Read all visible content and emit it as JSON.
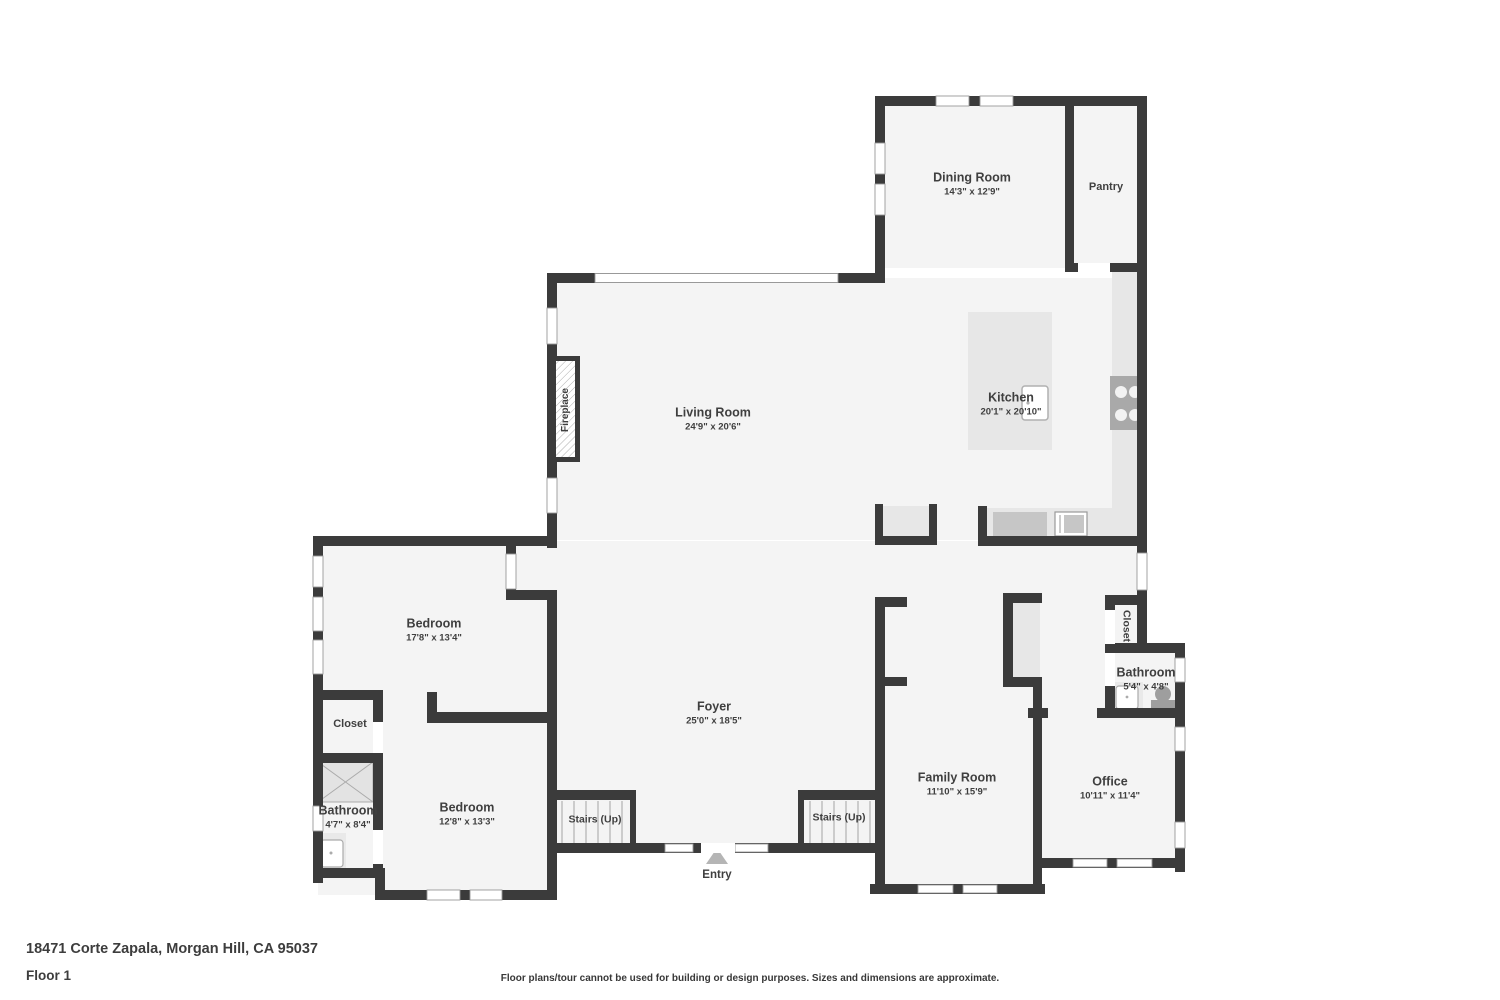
{
  "title": {
    "address": "18471 Corte Zapala, Morgan Hill, CA 95037",
    "floor_label": "Floor 1",
    "disclaimer": "Floor plans/tour cannot be used for building or design purposes. Sizes and dimensions are approximate."
  },
  "colors": {
    "wall": "#3b3b3b",
    "floor": "#f4f4f4",
    "fixture_light": "#e7e7e7",
    "fixture_mid": "#c6c6c6",
    "appliance": "#a9a9a9",
    "window_frame": "#999999",
    "text": "#3f3f3f"
  },
  "rooms": {
    "dining": {
      "name": "Dining Room",
      "dims": "14'3\" x 12'9\""
    },
    "pantry": {
      "name": "Pantry"
    },
    "living": {
      "name": "Living Room",
      "dims": "24'9\" x 20'6\""
    },
    "kitchen": {
      "name": "Kitchen",
      "dims": "20'1\" x 20'10\""
    },
    "fireplace": {
      "name": "Fireplace"
    },
    "bedroom1": {
      "name": "Bedroom",
      "dims": "17'8\" x 13'4\""
    },
    "closet_left": {
      "name": "Closet"
    },
    "bathroom_left": {
      "name": "Bathroom",
      "dims": "4'7\" x 8'4\""
    },
    "bedroom2": {
      "name": "Bedroom",
      "dims": "12'8\" x 13'3\""
    },
    "foyer": {
      "name": "Foyer",
      "dims": "25'0\" x 18'5\""
    },
    "stairs_left": {
      "name": "Stairs (Up)"
    },
    "stairs_right": {
      "name": "Stairs (Up)"
    },
    "entry": {
      "name": "Entry"
    },
    "family": {
      "name": "Family Room",
      "dims": "11'10\" x 15'9\""
    },
    "closet_right": {
      "name": "Closet"
    },
    "bathroom_right": {
      "name": "Bathroom",
      "dims": "5'4\" x 4'8\""
    },
    "office": {
      "name": "Office",
      "dims": "10'11\" x 11'4\""
    }
  }
}
